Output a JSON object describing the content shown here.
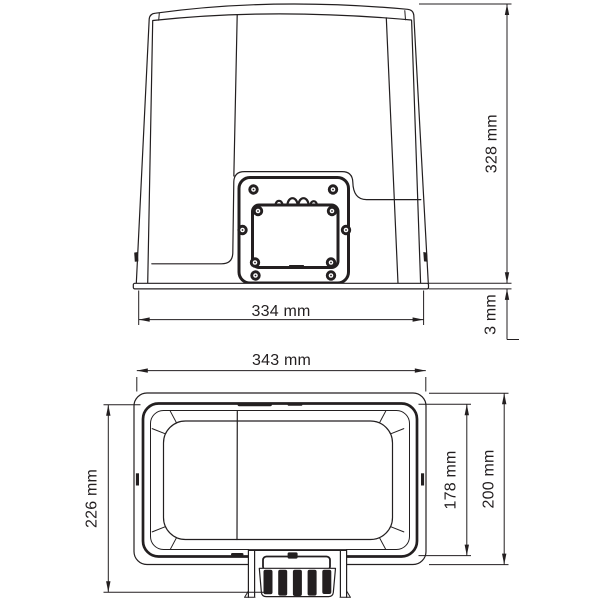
{
  "drawing": {
    "background": "#ffffff",
    "line_color": "#231f20",
    "views": {
      "front": {
        "dim_base_width": {
          "label": "334 mm",
          "value": 334,
          "unit": "mm"
        },
        "dim_height": {
          "label": "328 mm",
          "value": 328,
          "unit": "mm"
        },
        "dim_base_thickness": {
          "label": "3 mm",
          "value": 3,
          "unit": "mm"
        }
      },
      "top": {
        "dim_width": {
          "label": "343 mm",
          "value": 343,
          "unit": "mm"
        },
        "dim_depth_overall": {
          "label": "226 mm",
          "value": 226,
          "unit": "mm"
        },
        "dim_depth_body": {
          "label": "178 mm",
          "value": 178,
          "unit": "mm"
        },
        "dim_depth_cover": {
          "label": "200 mm",
          "value": 200,
          "unit": "mm"
        }
      }
    }
  }
}
